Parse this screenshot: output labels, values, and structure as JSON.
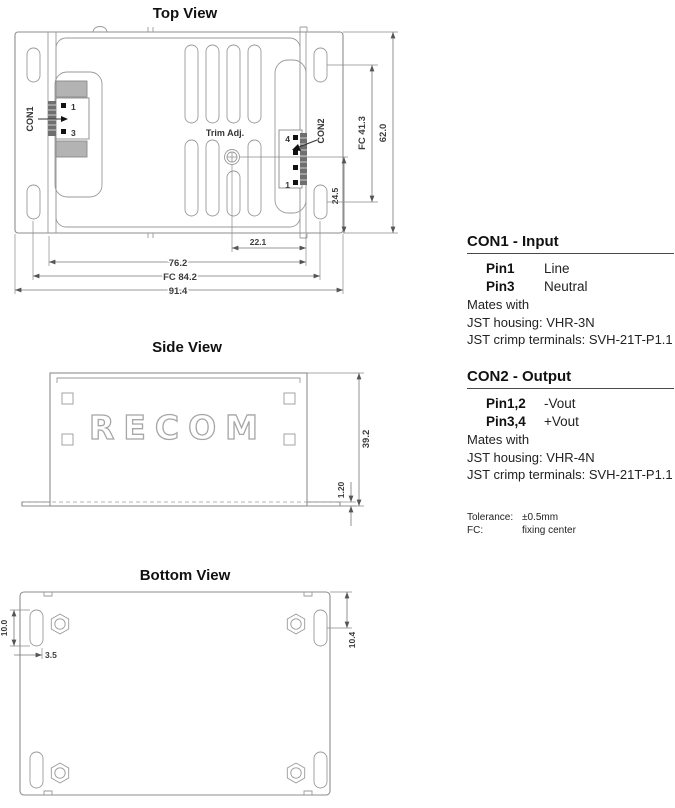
{
  "top_view": {
    "title": "Top View",
    "labels": {
      "con1": "CON1",
      "con2": "CON2",
      "trim": "Trim Adj.",
      "con1_pin_top": "1",
      "con1_pin_bottom": "3",
      "con2_pin_top": "4",
      "con2_pin_bottom": "1"
    },
    "dims": {
      "trim_to_edge": "22.1",
      "case_width": "76.2",
      "fixing_center_width": "FC 84.2",
      "overall_width": "91.4",
      "trim_to_bottom": "24.5",
      "fixing_center_height": "FC 41.3",
      "overall_height": "62.0"
    }
  },
  "side_view": {
    "title": "Side View",
    "logo": "RECOM",
    "dims": {
      "overall_height": "39.2",
      "flange_thickness": "1.20"
    }
  },
  "bottom_view": {
    "title": "Bottom View",
    "dims": {
      "slot_length": "10.0",
      "slot_width": "3.5",
      "slot_center_from_edge": "10.4"
    }
  },
  "con1_info": {
    "heading": "CON1 - Input",
    "pins": [
      {
        "label": "Pin1",
        "value": "Line"
      },
      {
        "label": "Pin3",
        "value": "Neutral"
      }
    ],
    "mates": "Mates with",
    "housing": "JST housing: VHR-3N",
    "crimp": "JST crimp terminals: SVH-21T-P1.1"
  },
  "con2_info": {
    "heading": "CON2 - Output",
    "pins": [
      {
        "label": "Pin1,2",
        "value": "-Vout"
      },
      {
        "label": "Pin3,4",
        "value": "+Vout"
      }
    ],
    "mates": "Mates with",
    "housing": "JST housing: VHR-4N",
    "crimp": "JST crimp terminals: SVH-21T-P1.1"
  },
  "footnotes": {
    "tolerance_label": "Tolerance:",
    "tolerance_value": "±0.5mm",
    "fc_label": "FC:",
    "fc_value": "fixing center"
  },
  "colors": {
    "line": "#8e8e8e",
    "dim_line": "#777777",
    "text_dark": "#1a1a1a",
    "fill_gray": "#b3b3b3",
    "pin_black": "#111111"
  }
}
